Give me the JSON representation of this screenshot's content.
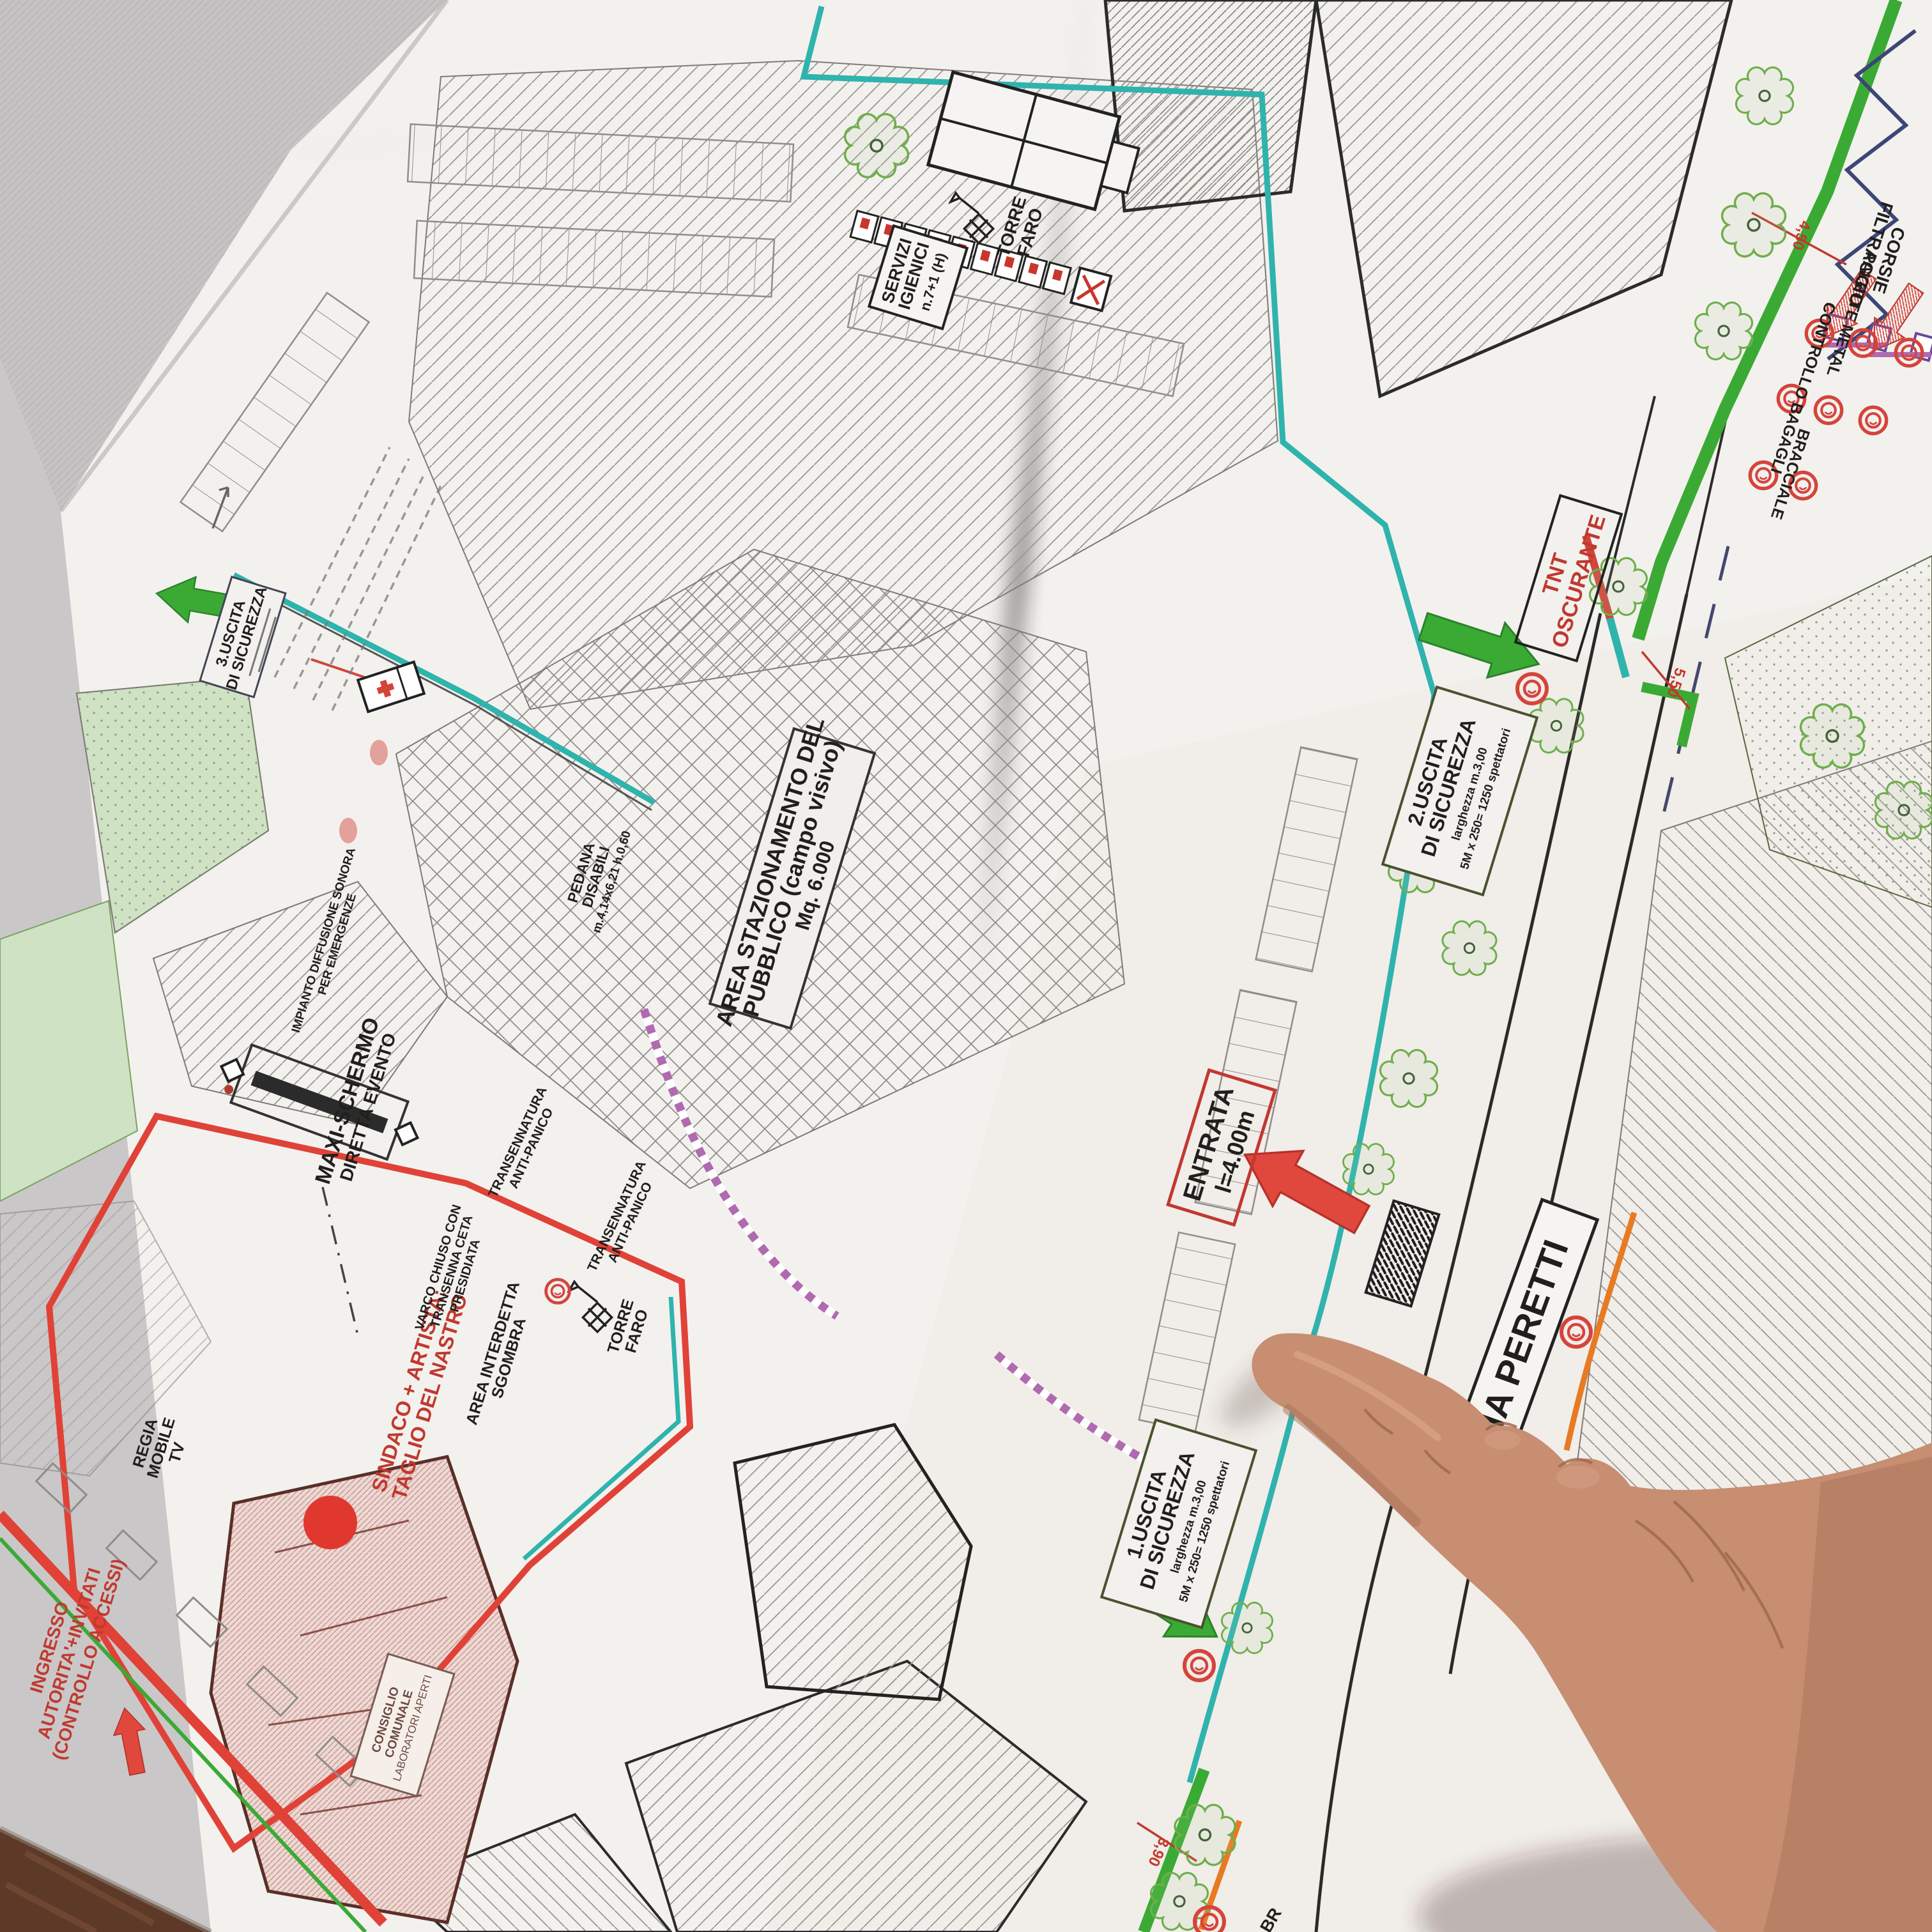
{
  "labels": {
    "servizi_igienici": {
      "l1": "SERVIZI",
      "l2": "IGIENICI",
      "l3": "n.7+1 (H)"
    },
    "torre_faro_top": {
      "l1": "TORRE",
      "l2": "FARO"
    },
    "torre_faro_stage": {
      "l1": "TORRE",
      "l2": "FARO"
    },
    "area_stazionamento": {
      "l1": "AREA STAZIONAMENTO DEL",
      "l2": "PUBBLICO (campo visivo)",
      "l3": "Mq. 6.000"
    },
    "tnt_oscurante": {
      "l1": "TNT",
      "l2": "OSCURANTE"
    },
    "uscita2": {
      "l1": "2.USCITA",
      "l2": "DI SICUREZZA",
      "l3": "larghezza m.3,00",
      "l4": "5M x 250= 1250 spettatori"
    },
    "uscita1": {
      "l1": "1.USCITA",
      "l2": "DI SICUREZZA",
      "l3": "larghezza m.3,00",
      "l4": "5M x 250= 1250 spettatori"
    },
    "uscita3": {
      "l1": "3.USCITA",
      "l2": "DI SICUREZZA"
    },
    "entrata": {
      "l1": "ENTRATA",
      "l2": "l=4.00m"
    },
    "via_peretti": {
      "l1": "VIA PERETTI"
    },
    "maxi_schermo": {
      "l1": "MAXI-SCHERMO",
      "l2": "DIRETTA EVENTO"
    },
    "transennatura_a": {
      "l1": "TRANSENNATURA",
      "l2": "ANTI-PANICO"
    },
    "transennatura_b": {
      "l1": "TRANSENNATURA",
      "l2": "ANTI-PANICO"
    },
    "sindaco": {
      "l1": "SINDACO + ARTISTA:",
      "l2": "TAGLIO DEL NASTRO"
    },
    "varco_chiuso": {
      "l1": "VARCO CHIUSO CON",
      "l2": "TRANSENNA CETA",
      "l3": "PRESIDIATA"
    },
    "area_interdetta": {
      "l1": "AREA INTERDETTA",
      "l2": "SGOMBRA"
    },
    "regia": {
      "l1": "REGIA",
      "l2": "MOBILE",
      "l3": "TV"
    },
    "ingresso_autorita": {
      "l1": "INGRESSO",
      "l2": "AUTORITA'+INVITATI",
      "l3": "(CONTROLLO ACCESSI)"
    },
    "pedana": {
      "l1": "PEDANA",
      "l2": "DISABILI",
      "l3": "m.4,14x6,21 h.0,60"
    },
    "impianto": {
      "l1": "IMPIANTO DIFFUSIONE SONORA",
      "l2": "PER EMERGENZE"
    },
    "corsie": {
      "l1": "CORSIE",
      "l2": "FILTRAGGIO"
    },
    "palette_metal": {
      "l1": "PALETTE METAL"
    },
    "controllo_bagagli": {
      "l1": "CONTROLLO BAGAGLI"
    },
    "bracciale": {
      "l1": "BRACCIALE"
    },
    "consiglio": {
      "l1": "CONSIGLIO",
      "l2": "COMUNALE",
      "l3": "LABORATORI APERTI"
    },
    "br_partial": {
      "l1": "BR"
    }
  },
  "dims": {
    "d450": "4,50",
    "d550": "5,50",
    "d390": "3,90"
  },
  "colors": {
    "route_green": "#3aaa35",
    "boundary_teal": "#2fb3ad",
    "alert_red": "#d5443b",
    "orange_line": "#e87a22",
    "barrier_purple": "#b06ab0"
  }
}
